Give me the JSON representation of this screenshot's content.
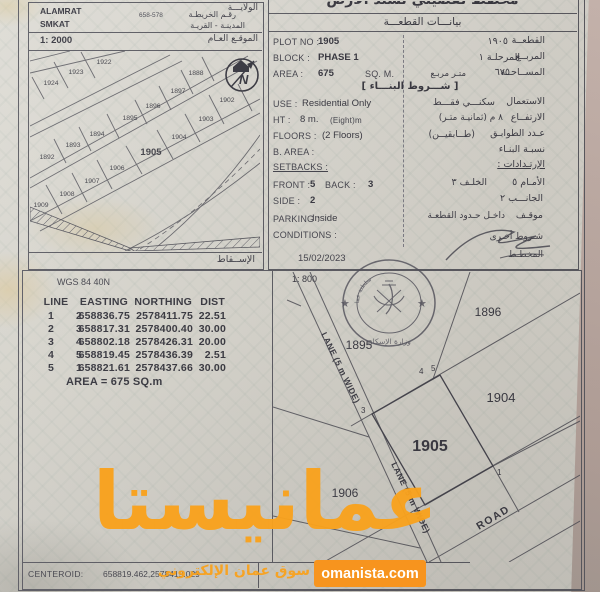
{
  "doc": {
    "left": {
      "state": "ALAMRAT",
      "state_ar": "الولايـــة",
      "town": "SMKAT",
      "town_ar": "المدينـة - القريـة",
      "map_no_ar": "رقـم الخريطـة",
      "map_no": "658-578",
      "scale": "1: 2000",
      "location_ar": "الموقـع العـام",
      "projection_ar": "الإســقاط"
    },
    "right": {
      "title_ar": "مخطط تفصيلي لسند الأرض",
      "section_ar": "بيانـــات القطعـــة",
      "plot_label": "PLOT NO :",
      "plot": "1905",
      "plot_ar": "١٩٠٥",
      "plot_label_ar": "القطعــة",
      "block_label": "BLOCK :",
      "block": "PHASE 1",
      "block_ar": "المرحلـة ١",
      "block_label_ar": "المربــع",
      "area_label": "AREA :",
      "area": "675",
      "area_unit": "SQ. M.",
      "area_ar": "٦٧٥",
      "area_unit_ar": "متـر مربـع",
      "area_label_ar": "المســاحــة",
      "terms_ar": "[ شـــروط البنـــاء ]",
      "use_label": "USE :",
      "use": "Residential Only",
      "use_ar": "سكنـــي فقـــط",
      "use_label_ar": "الاستعمال",
      "ht_label": "HT :",
      "ht": "8 m.",
      "ht_note": "(Eight)m",
      "ht_ar": "٨  م  (ثمانيـة متـر)",
      "ht_label_ar": "الارتفــاع",
      "floors_label": "FLOORS :",
      "floors": "(2 Floors)",
      "floors_ar": "(طــابقيــن)",
      "floors_label_ar": "عـدد الطوابـق",
      "barea_label": "B. AREA :",
      "barea_label_ar": "نسبـة البنـاء",
      "setbacks_label": "SETBACKS :",
      "setbacks_label_ar": "الإرتـدادات :",
      "front_label": "FRONT :",
      "front": "5",
      "back_label": "BACK :",
      "back": "3",
      "front_ar": "الأمـام  ٥",
      "back_ar": "الخلـف  ٣",
      "side_label": "SIDE :",
      "side": "2",
      "side_ar": "الجانـــب  ٢",
      "parking_label": "PARKING :",
      "parking": "Inside",
      "parking_ar": "داخـل حـدود القطعـة",
      "parking_label_ar": "موقـف",
      "conditions_label": "CONDITIONS :",
      "conditions_label_ar": "شـروط أخـرى",
      "date": "15/02/2023",
      "planner_ar": "المخطـط"
    },
    "coords": {
      "datum": "WGS 84  40N",
      "h_line": "LINE",
      "h_easting": "EASTING",
      "h_northing": "NORTHING",
      "h_dist": "DIST",
      "rows": [
        [
          "1",
          "2",
          "658836.75",
          "2578411.75",
          "22.51"
        ],
        [
          "2",
          "3",
          "658817.31",
          "2578400.40",
          "30.00"
        ],
        [
          "3",
          "4",
          "658802.18",
          "2578426.31",
          "20.00"
        ],
        [
          "4",
          "5",
          "658819.45",
          "2578436.39",
          "2.51"
        ],
        [
          "5",
          "1",
          "658821.61",
          "2578437.66",
          "30.00"
        ]
      ],
      "area_line": "AREA = 675  SQ.m",
      "centeroid_label": "CENTEROID:",
      "centeroid": "658819.462,2578419.029"
    },
    "overview": {
      "plots": [
        "1922",
        "1923",
        "1924",
        "1888",
        "1897",
        "1896",
        "1902",
        "1895",
        "1903",
        "1894",
        "1904",
        "1893",
        "1905",
        "1892",
        "1906",
        "1907",
        "1908",
        "1909"
      ]
    },
    "detail": {
      "scale": "1: 800",
      "p1896": "1896",
      "p1895": "1895",
      "p1904": "1904",
      "p1905": "1905",
      "p1906": "1906",
      "lane": "LANE  (5 m WIDE)",
      "road": "ROAD",
      "c1": "1",
      "c2": "2",
      "c3": "3",
      "c4": "4",
      "c5": "5",
      "north": "N"
    },
    "stamp": {
      "country": "سلطنة عمان",
      "ministry": "وزارة الإسكان"
    },
    "watermark": {
      "brand": "عمانيستا",
      "tagline": "سوق عمان الإلكتروني",
      "site": "omanista.com"
    },
    "colors": {
      "orange": "#F89B1C",
      "ink": "#3A3A44"
    }
  }
}
